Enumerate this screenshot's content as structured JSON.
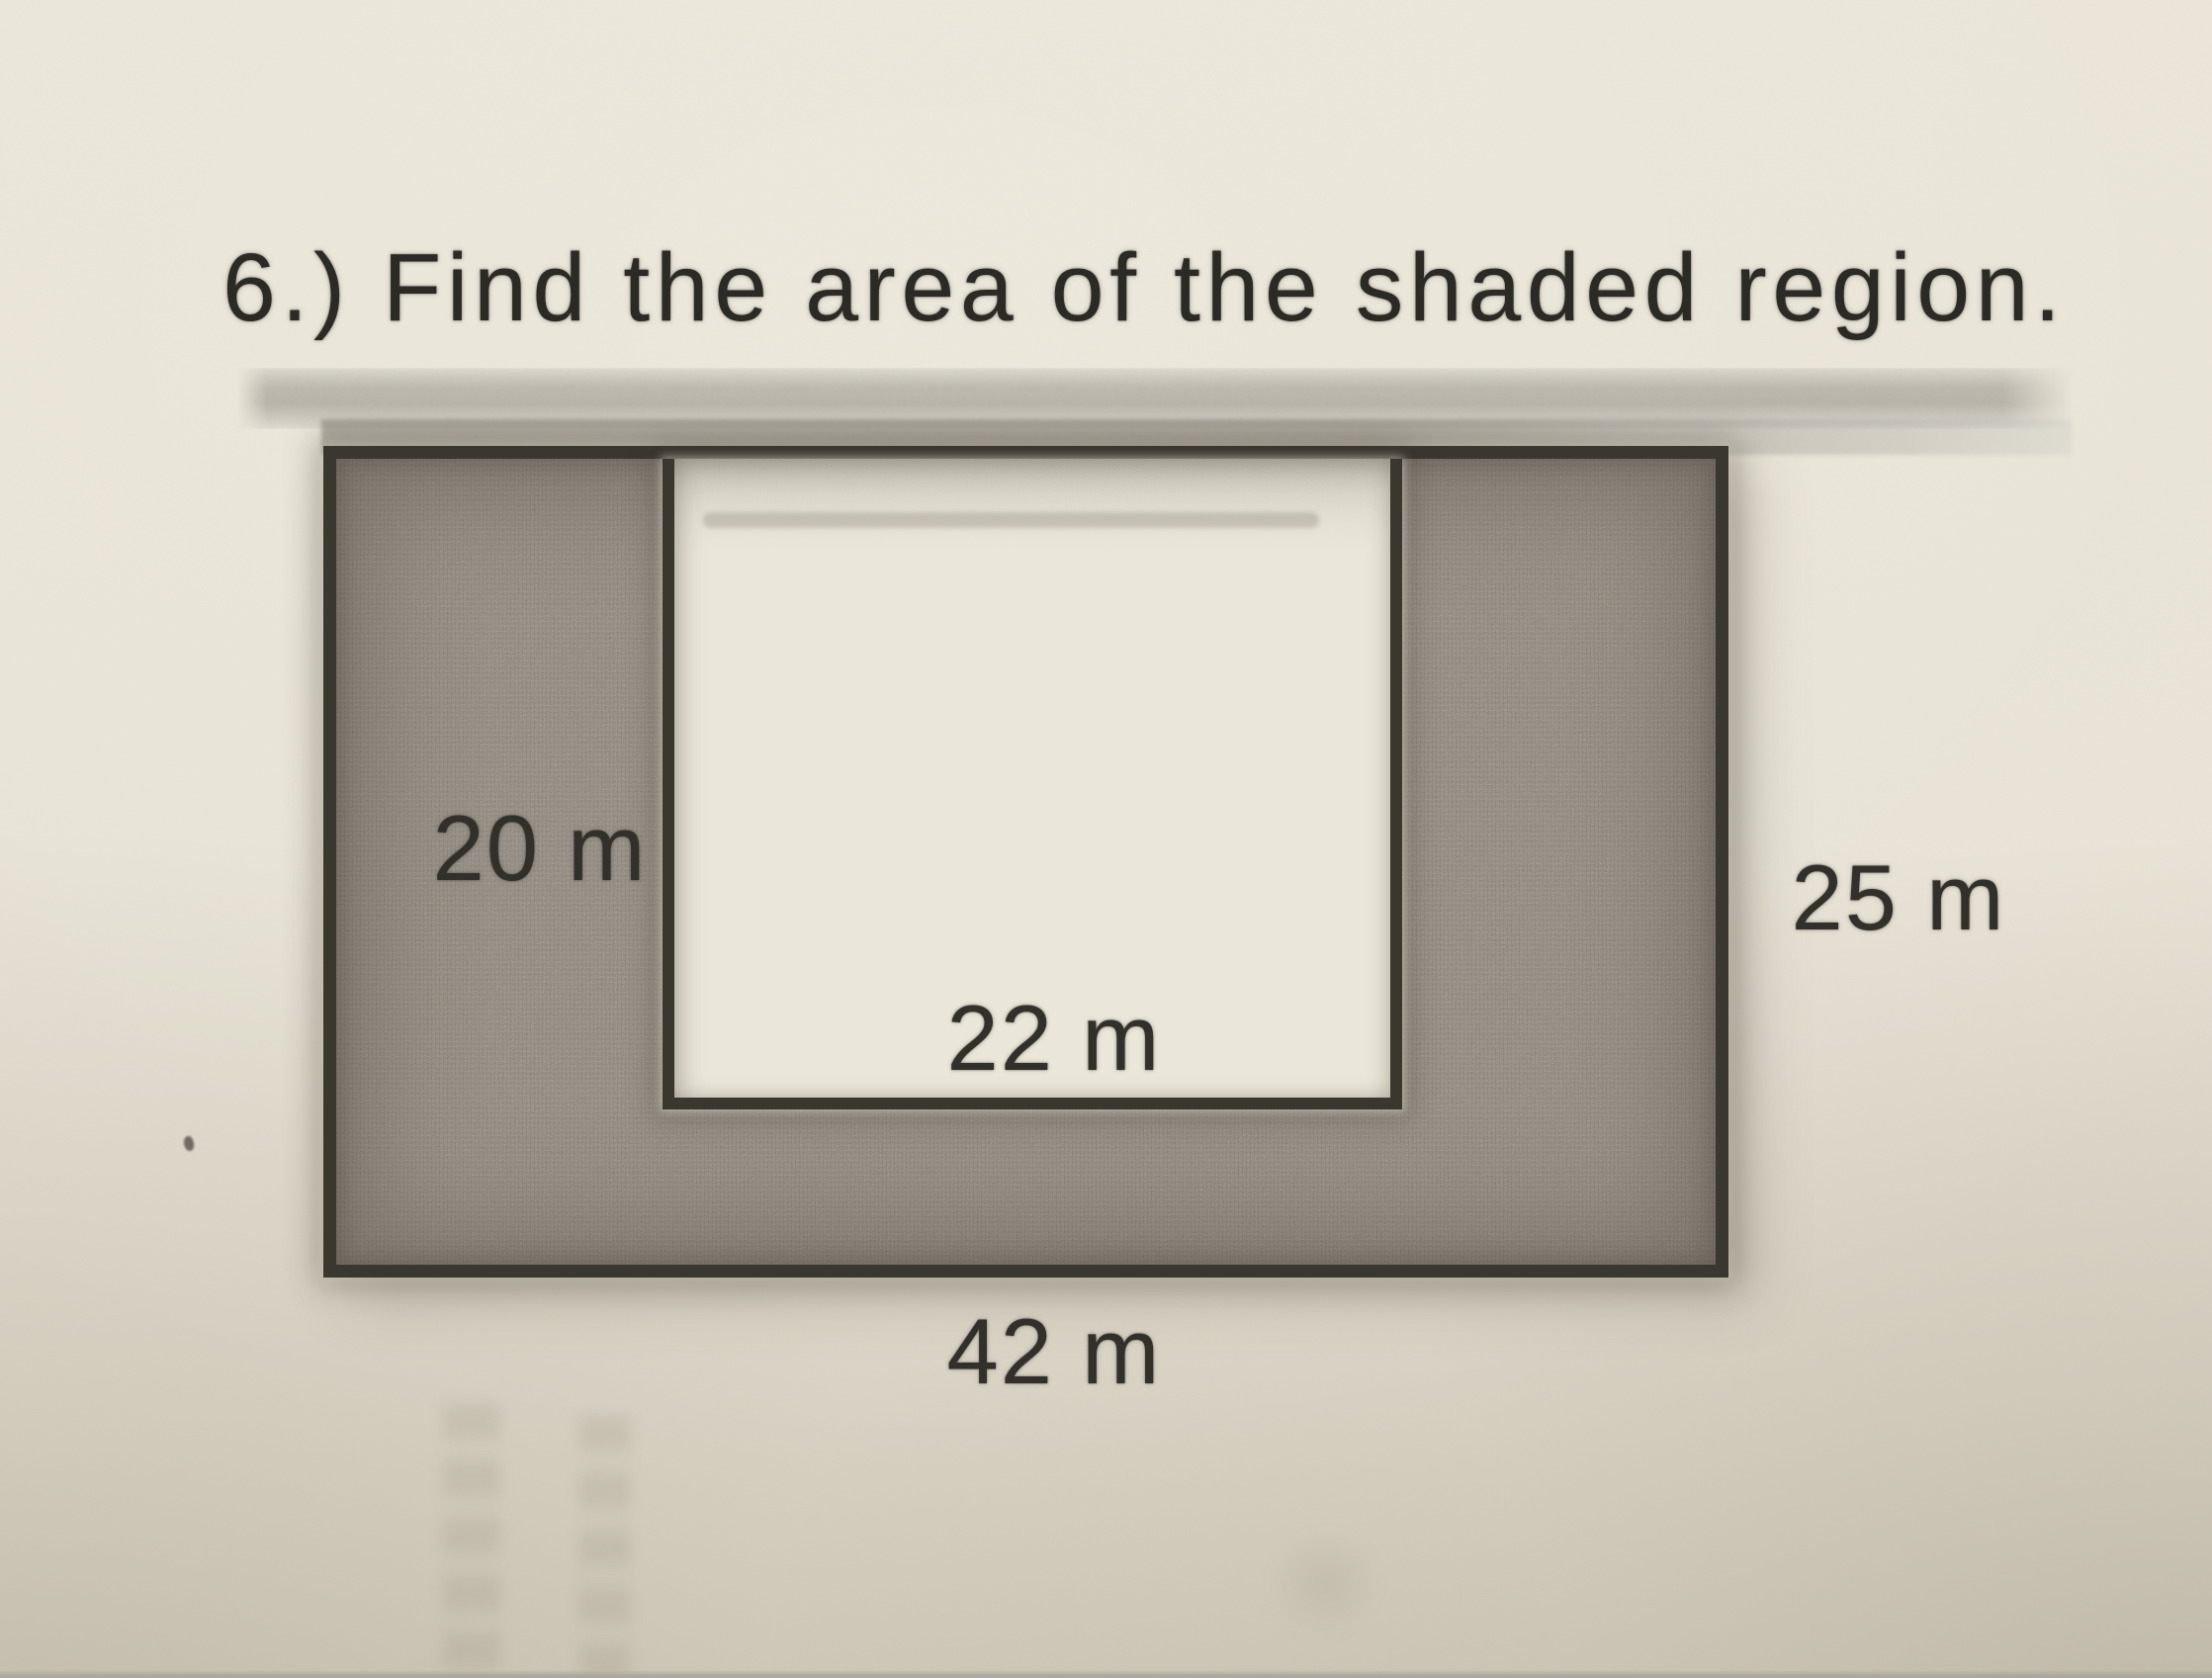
{
  "problem": {
    "title": "6.) Find the area of the shaded region.",
    "labels": {
      "inner_height": "20 m",
      "inner_width": "22 m",
      "outer_height": "25 m",
      "outer_width": "42 m"
    },
    "figure": {
      "type": "shaded-rectangle-with-white-rectangular-cutout",
      "outer_rect_m": {
        "width": 42,
        "height": 25
      },
      "cutout_rect_m": {
        "width": 22,
        "height": 20
      },
      "shaded_part": "region between outer rectangle and cutout"
    },
    "colors": {
      "paper": "#e7e2d4",
      "shaded_fill": "#8d8578",
      "outline_ink": "#3a372e",
      "text_ink": "#2c2a25"
    }
  }
}
